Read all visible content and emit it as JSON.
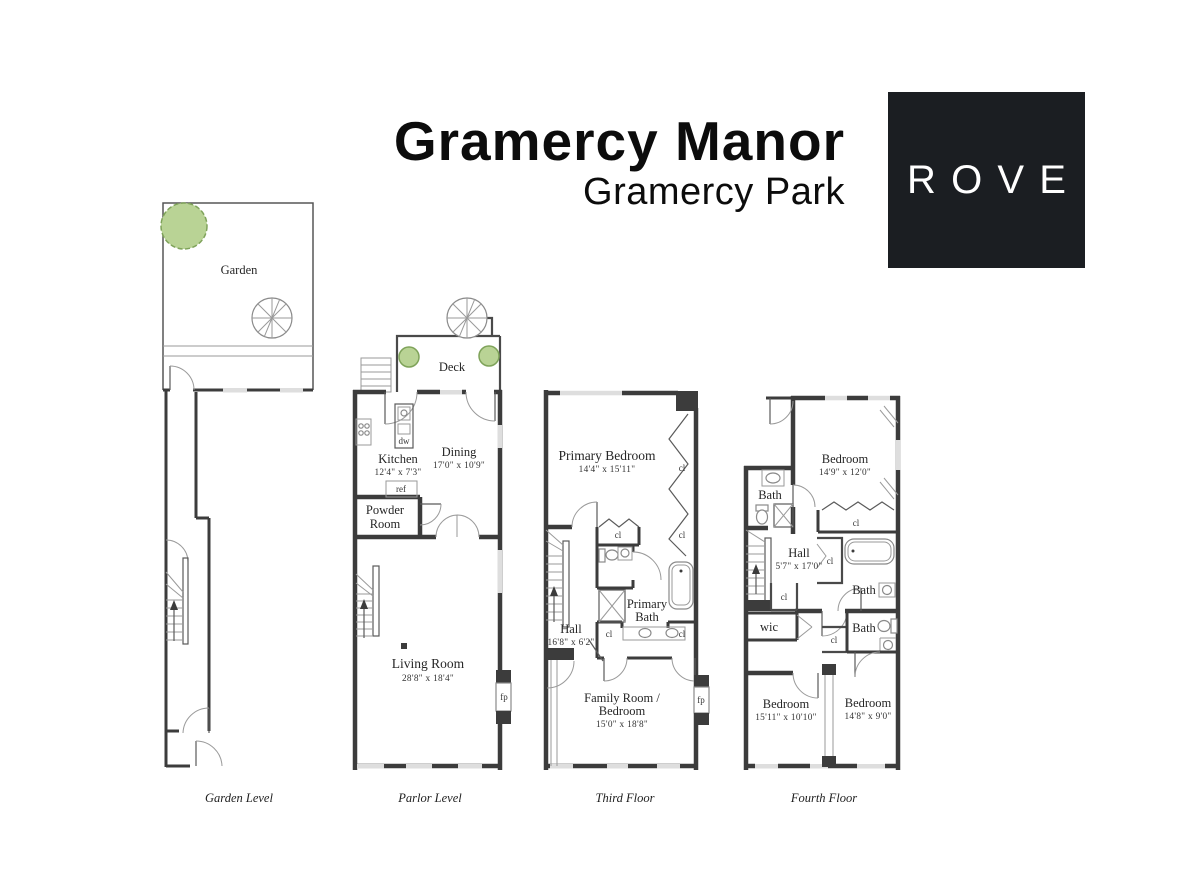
{
  "header": {
    "title": "Gramercy Manor",
    "subtitle": "Gramercy Park",
    "logo_text": "ROVE"
  },
  "palette": {
    "wall": "#3c3c3c",
    "window": "#dedede",
    "tree_fill": "#b9d395",
    "tree_stroke": "#7fa35a",
    "logo_bg": "#1b1e22",
    "logo_text": "#ffffff"
  },
  "tags": {
    "cl": "cl",
    "fp": "fp",
    "ref": "ref",
    "dw": "dw",
    "wic": "wic"
  },
  "floors": {
    "garden": {
      "caption": "Garden Level",
      "garden_label": "Garden"
    },
    "parlor": {
      "caption": "Parlor Level",
      "deck": "Deck",
      "kitchen": {
        "name": "Kitchen",
        "dims": "12'4\" x 7'3\""
      },
      "dining": {
        "name": "Dining",
        "dims": "17'0\" x 10'9\""
      },
      "powder_line1": "Powder",
      "powder_line2": "Room",
      "living": {
        "name": "Living Room",
        "dims": "28'8\" x 18'4\""
      }
    },
    "third": {
      "caption": "Third Floor",
      "primary_bedroom": {
        "name": "Primary Bedroom",
        "dims": "14'4\" x 15'11\""
      },
      "hall": {
        "name": "Hall",
        "dims": "16'8\" x 6'2\""
      },
      "primary_bath_line1": "Primary",
      "primary_bath_line2": "Bath",
      "family": {
        "line1": "Family Room /",
        "line2": "Bedroom",
        "dims": "15'0\" x 18'8\""
      }
    },
    "fourth": {
      "caption": "Fourth Floor",
      "bedroom_top": {
        "name": "Bedroom",
        "dims": "14'9\" x 12'0\""
      },
      "hall": {
        "name": "Hall",
        "dims": "5'7\" x 17'0\""
      },
      "bath": "Bath",
      "bedroom_left": {
        "name": "Bedroom",
        "dims": "15'11\" x 10'10\""
      },
      "bedroom_right": {
        "name": "Bedroom",
        "dims": "14'8\" x 9'0\""
      }
    }
  }
}
